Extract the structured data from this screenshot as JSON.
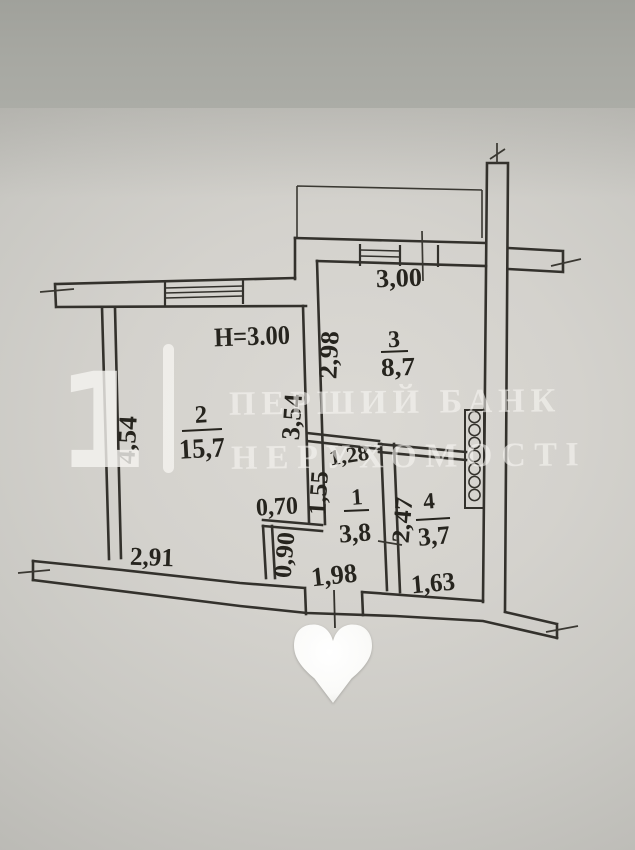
{
  "floor_plan": {
    "ceiling_height": "Н=3.00",
    "rooms": [
      {
        "number": "1",
        "area": "3,8"
      },
      {
        "number": "2",
        "area": "15,7"
      },
      {
        "number": "3",
        "area": "8,7"
      },
      {
        "number": "4",
        "area": "3,7"
      }
    ],
    "dimensions": {
      "room3_top_width": "3,00",
      "room3_left_height": "2,98",
      "room2_right_height": "3,54",
      "room2_left_height": "4,54",
      "room2_bottom_width": "2,91",
      "hall_top_width": "1,28",
      "hall_left_height": "1,55",
      "hall_niche_width": "0,70",
      "hall_niche_height": "0,90",
      "hall_bottom_width": "1,98",
      "room4_left_height": "2,47",
      "room4_bottom_width": "1,63"
    }
  },
  "watermark": {
    "digit": "1",
    "brand_line1": "ПЕРШИЙ БАНК",
    "brand_line2": "НЕРУХОМОСТІ",
    "heart_icon": "white-heart"
  },
  "colors": {
    "paper": "#d6d4cf",
    "background_band": "#a7a8a2",
    "ink": "#33312c",
    "watermark_white": "#f5f4f0"
  }
}
